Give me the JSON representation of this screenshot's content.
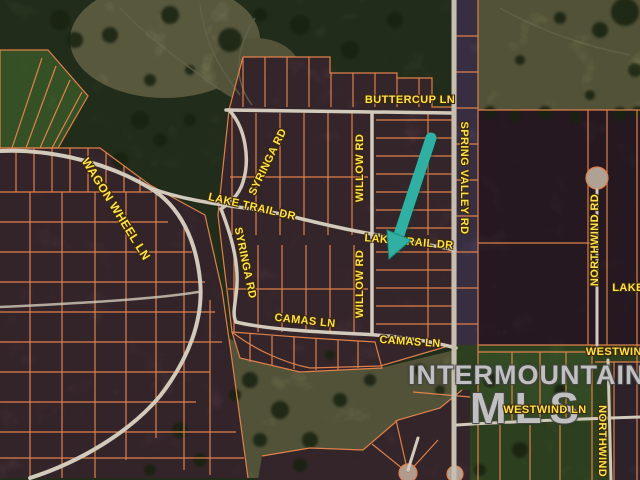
{
  "road_labels": {
    "buttercup_ln": "BUTTERCUP LN",
    "syringa_rd_upper": "SYRINGA RD",
    "syringa_rd_lower": "SYRINGA RD",
    "willow_rd_upper": "WILLOW RD",
    "willow_rd_lower": "WILLOW RD",
    "spring_valley_rd": "SPRING VALLEY RD",
    "lake_trail_dr_west": "LAKE TRAIL DR",
    "lake_trail_dr_east": "LAKE TRAIL DR",
    "wagon_wheel_ln": "WAGON WHEEL LN",
    "camas_ln_west": "CAMAS LN",
    "camas_ln_east": "CAMAS LN",
    "northwind_rd": "NORTHWIND RD",
    "northwind_rd_south": "NORTHWIND R",
    "lake_cut": "LAKE",
    "westwind_cut": "WESTWIND",
    "westwind_ln": "WESTWIND LN"
  },
  "watermark": {
    "line1": "INTERMOUNTAIN",
    "line2": "MLS"
  },
  "colors": {
    "parcel_line": "#e8854c",
    "road_label": "#ffe14b",
    "arrow_teal": "#2fb0a2",
    "road": "#d2cabb",
    "watermark_gray": "#d6d6d6"
  }
}
